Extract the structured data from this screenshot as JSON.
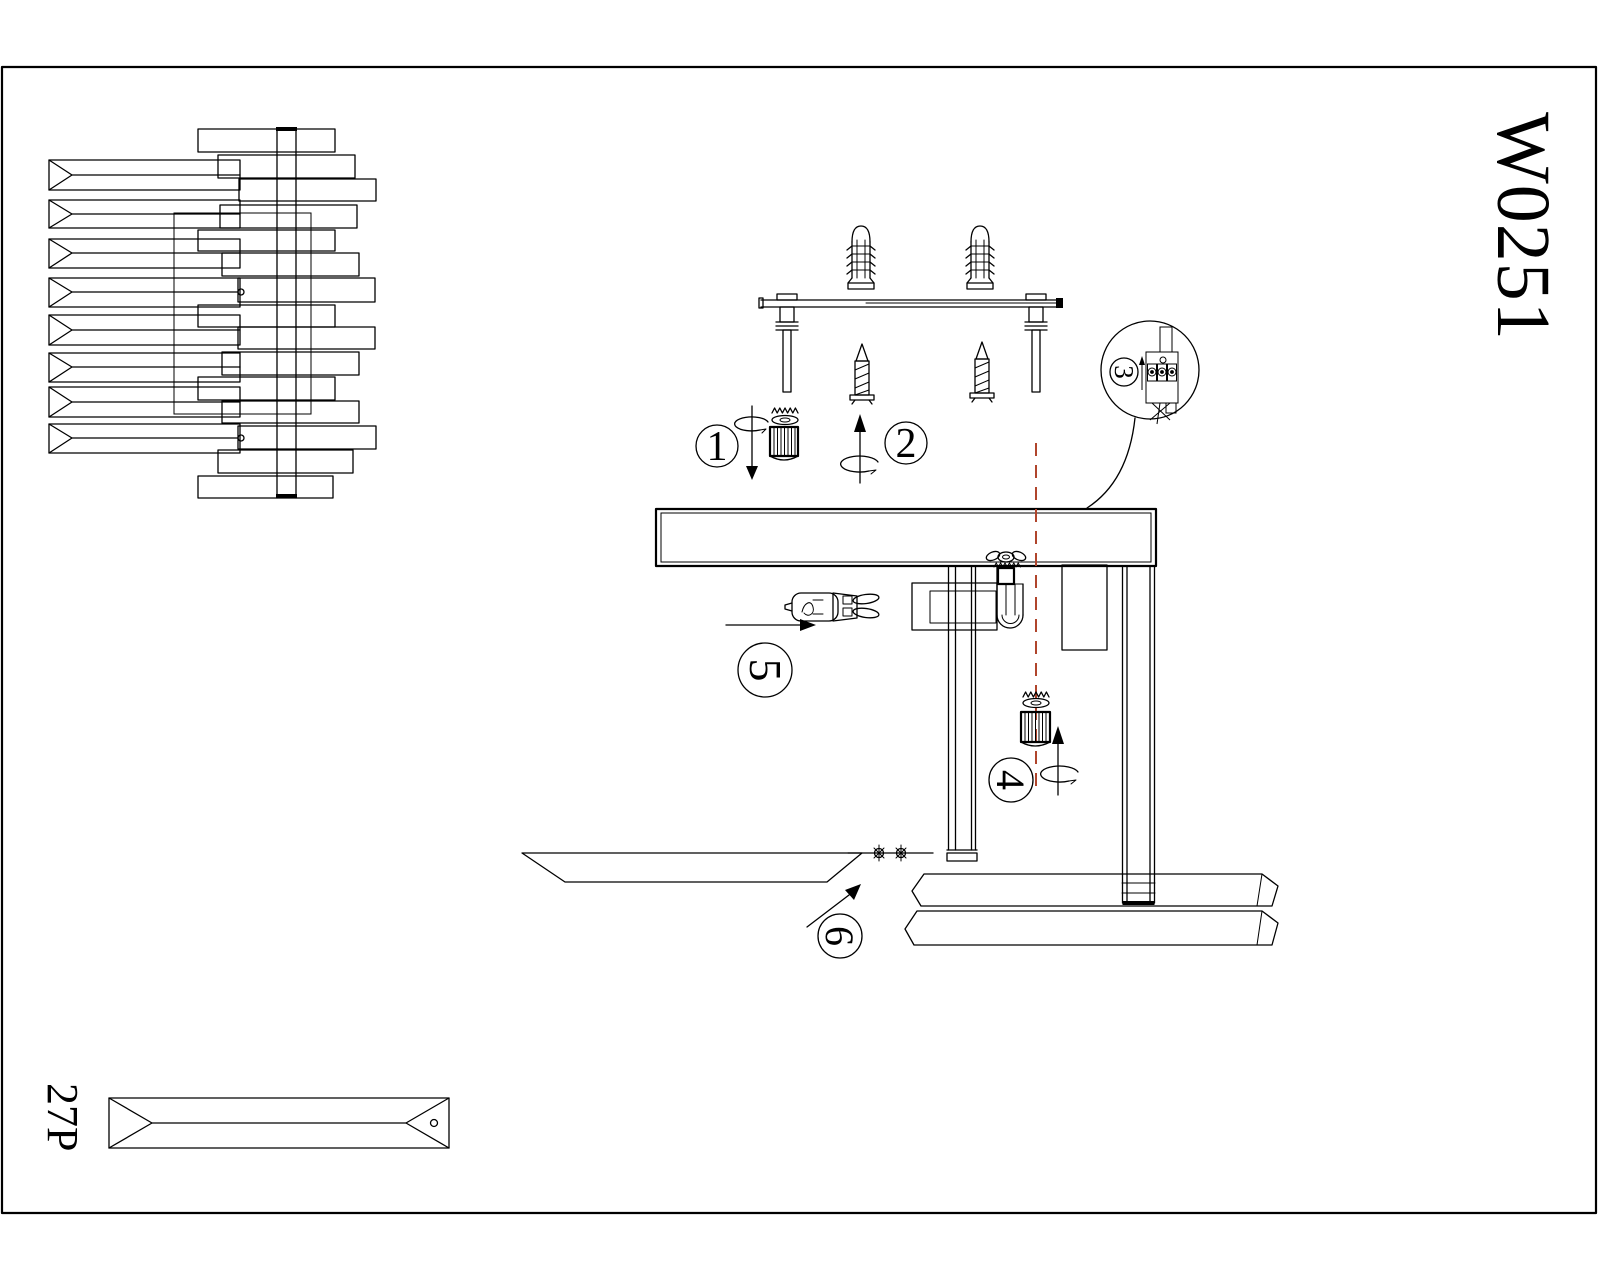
{
  "document": {
    "type": "lighting fixture assembly instruction sheet",
    "model_code": "W0251",
    "crystal_part_code": "27P"
  },
  "steps": {
    "s1": "1",
    "s2": "2",
    "s3": "3",
    "s4": "4",
    "s5": "5",
    "s6": "6"
  },
  "colors": {
    "line": "#000000",
    "background": "#ffffff",
    "center_axis_dashed": "#b0452c"
  }
}
